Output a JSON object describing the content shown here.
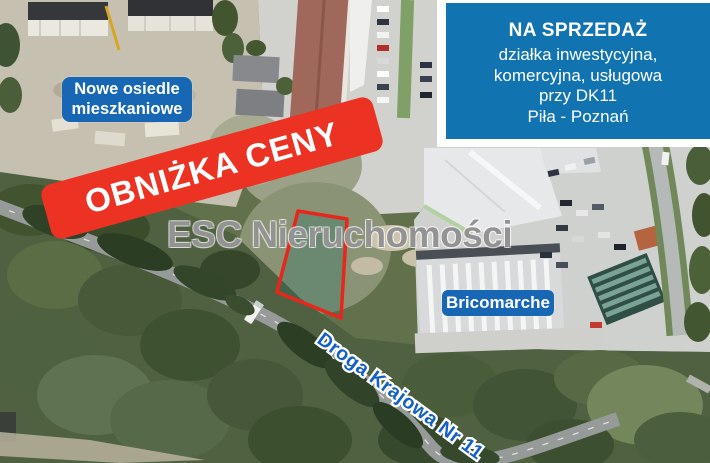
{
  "info_box": {
    "title": "NA SPRZEDAŻ",
    "lines": [
      "działka inwestycyjna,",
      "komercyjna, usługowa",
      "przy DK11",
      "Piła - Poznań"
    ],
    "bg_color": "#1173b0"
  },
  "banner": {
    "text": "OBNIŻKA CENY",
    "bg_color": "#ec3223"
  },
  "watermark": {
    "text": "ESC Nieruchomości",
    "color": "#8a8a8a"
  },
  "labels": {
    "new_estate_line1": "Nowe osiedle",
    "new_estate_line2": "mieszkaniowe",
    "store_label": "Bricomarche",
    "road_label": "Droga Krajowa Nr 11",
    "label_bg_color": "#1767b4",
    "road_text_color": "#1560c4"
  },
  "plot": {
    "outline_color": "#e8271c",
    "fill_tint": "teal"
  }
}
